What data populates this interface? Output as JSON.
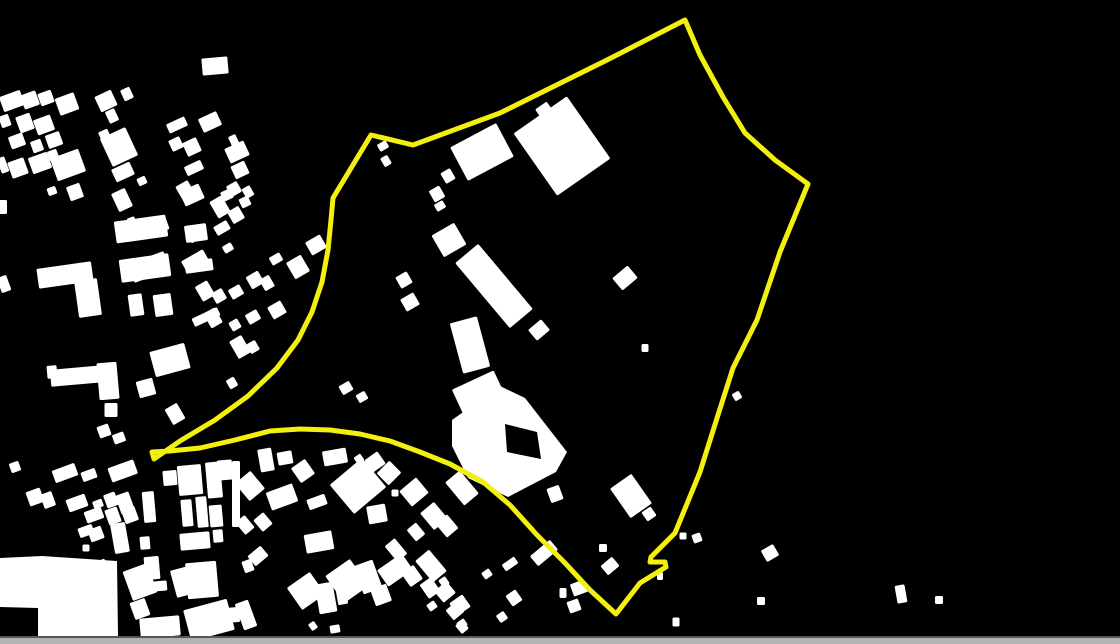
{
  "scene": {
    "width": 1120,
    "height": 644,
    "background_color": "#000000"
  },
  "map": {
    "building_color": "#ffffff",
    "buildings": [
      [
        12,
        101,
        22,
        16,
        -20
      ],
      [
        30,
        100,
        16,
        15,
        -20
      ],
      [
        46,
        98,
        14,
        13,
        -20
      ],
      [
        67,
        104,
        20,
        18,
        -20
      ],
      [
        106,
        101,
        18,
        17,
        -25
      ],
      [
        112,
        116,
        10,
        13,
        -25
      ],
      [
        127,
        94,
        10,
        12,
        -25
      ],
      [
        5,
        121,
        10,
        12,
        -20
      ],
      [
        25,
        123,
        15,
        17,
        -20
      ],
      [
        44,
        125,
        18,
        16,
        -20
      ],
      [
        54,
        140,
        15,
        14,
        -20
      ],
      [
        17,
        141,
        15,
        13,
        -20
      ],
      [
        37,
        146,
        11,
        12,
        -20
      ],
      [
        53,
        155,
        10,
        10,
        -20
      ],
      [
        3,
        165,
        8,
        16,
        -20
      ],
      [
        18,
        168,
        17,
        17,
        -20
      ],
      [
        40,
        163,
        20,
        17,
        -20
      ],
      [
        68,
        165,
        30,
        24,
        -20
      ],
      [
        75,
        192,
        14,
        15,
        -20
      ],
      [
        52,
        191,
        9,
        8,
        -20
      ],
      [
        105,
        136,
        10,
        12,
        -25
      ],
      [
        119,
        147,
        28,
        31,
        -25
      ],
      [
        123,
        172,
        20,
        14,
        -25
      ],
      [
        142,
        181,
        9,
        8,
        -25
      ],
      [
        122,
        200,
        15,
        20,
        -25
      ],
      [
        177,
        125,
        20,
        10,
        -25
      ],
      [
        176,
        144,
        12,
        12,
        -25
      ],
      [
        192,
        147,
        15,
        15,
        -25
      ],
      [
        194,
        168,
        18,
        10,
        -25
      ],
      [
        210,
        122,
        20,
        15,
        -25
      ],
      [
        215,
        66,
        26,
        17,
        -5
      ],
      [
        234,
        141,
        8,
        12,
        -25
      ],
      [
        237,
        152,
        21,
        16,
        -25
      ],
      [
        240,
        170,
        15,
        14,
        -25
      ],
      [
        227,
        195,
        11,
        10,
        -25
      ],
      [
        245,
        202,
        10,
        10,
        -25
      ],
      [
        192,
        195,
        21,
        16,
        -25
      ],
      [
        3,
        207,
        8,
        14,
        0
      ],
      [
        4,
        284,
        10,
        16,
        -20
      ],
      [
        65,
        275,
        55,
        20,
        -8
      ],
      [
        88,
        298,
        23,
        37,
        -8
      ],
      [
        141,
        229,
        52,
        22,
        -8
      ],
      [
        145,
        268,
        50,
        23,
        -8
      ],
      [
        136,
        305,
        14,
        22,
        -8
      ],
      [
        163,
        305,
        18,
        22,
        -8
      ],
      [
        196,
        233,
        22,
        17,
        -8
      ],
      [
        199,
        266,
        28,
        12,
        -8
      ],
      [
        206,
        317,
        28,
        9,
        -25
      ],
      [
        170,
        360,
        36,
        26,
        -15
      ],
      [
        77,
        376,
        53,
        17,
        -5
      ],
      [
        52,
        372,
        10,
        13,
        -5
      ],
      [
        108,
        381,
        20,
        37,
        -5
      ],
      [
        111,
        410,
        13,
        14,
        0
      ],
      [
        175,
        414,
        14,
        18,
        -30
      ],
      [
        104,
        431,
        12,
        12,
        -20
      ],
      [
        119,
        438,
        12,
        10,
        -20
      ],
      [
        146,
        388,
        17,
        17,
        -15
      ],
      [
        185,
        190,
        14,
        15,
        -30
      ],
      [
        220,
        207,
        14,
        19,
        -30
      ],
      [
        234,
        189,
        12,
        12,
        -30
      ],
      [
        248,
        192,
        9,
        11,
        -30
      ],
      [
        236,
        215,
        13,
        14,
        -30
      ],
      [
        222,
        228,
        15,
        10,
        -30
      ],
      [
        196,
        234,
        17,
        12,
        -30
      ],
      [
        133,
        225,
        8,
        16,
        -20
      ],
      [
        153,
        227,
        30,
        15,
        -20
      ],
      [
        149,
        267,
        38,
        20,
        -20
      ],
      [
        195,
        261,
        25,
        13,
        -30
      ],
      [
        228,
        248,
        10,
        8,
        -30
      ],
      [
        298,
        267,
        17,
        19,
        -30
      ],
      [
        316,
        245,
        17,
        15,
        -30
      ],
      [
        276,
        259,
        12,
        9,
        -30
      ],
      [
        205,
        291,
        14,
        17,
        -30
      ],
      [
        219,
        296,
        12,
        12,
        -30
      ],
      [
        236,
        292,
        13,
        11,
        -30
      ],
      [
        255,
        280,
        14,
        14,
        -30
      ],
      [
        267,
        283,
        11,
        13,
        -30
      ],
      [
        277,
        310,
        15,
        14,
        -30
      ],
      [
        253,
        317,
        13,
        11,
        -30
      ],
      [
        235,
        325,
        10,
        10,
        -30
      ],
      [
        213,
        318,
        13,
        17,
        -30
      ],
      [
        240,
        347,
        14,
        20,
        -30
      ],
      [
        253,
        347,
        10,
        11,
        -30
      ],
      [
        232,
        383,
        9,
        10,
        -30
      ],
      [
        346,
        388,
        12,
        10,
        -30
      ],
      [
        362,
        397,
        10,
        9,
        -30
      ],
      [
        383,
        146,
        10,
        8,
        -30
      ],
      [
        386,
        161,
        8,
        10,
        -30
      ],
      [
        562,
        146,
        65,
        76,
        -35
      ],
      [
        544,
        110,
        14,
        11,
        -35
      ],
      [
        482,
        152,
        52,
        38,
        -28
      ],
      [
        448,
        176,
        11,
        12,
        -30
      ],
      [
        437,
        194,
        12,
        13,
        -30
      ],
      [
        440,
        206,
        10,
        8,
        -30
      ],
      [
        449,
        240,
        26,
        25,
        -30
      ],
      [
        494,
        286,
        30,
        85,
        -40
      ],
      [
        539,
        330,
        17,
        14,
        -40
      ],
      [
        625,
        278,
        20,
        16,
        -40
      ],
      [
        645,
        348,
        7,
        8,
        0
      ],
      [
        737,
        396,
        8,
        8,
        -30
      ],
      [
        404,
        280,
        13,
        13,
        -30
      ],
      [
        410,
        302,
        15,
        14,
        -30
      ],
      [
        631,
        496,
        26,
        36,
        -35
      ],
      [
        649,
        514,
        11,
        11,
        -35
      ],
      [
        555,
        494,
        13,
        15,
        -20
      ],
      [
        603,
        548,
        8,
        8,
        0
      ],
      [
        683,
        536,
        7,
        7,
        0
      ],
      [
        697,
        538,
        9,
        9,
        -20
      ],
      [
        470,
        345,
        28,
        52,
        -15
      ],
      [
        482,
        400,
        46,
        44,
        -25
      ],
      [
        266,
        460,
        14,
        23,
        -10
      ],
      [
        285,
        458,
        15,
        13,
        -10
      ],
      [
        303,
        471,
        17,
        18,
        -35
      ],
      [
        335,
        457,
        24,
        15,
        -10
      ],
      [
        359,
        459,
        8,
        8,
        -35
      ],
      [
        375,
        462,
        16,
        15,
        -35
      ],
      [
        389,
        473,
        18,
        17,
        -45
      ],
      [
        358,
        486,
        42,
        38,
        -40
      ],
      [
        395,
        493,
        7,
        7,
        0
      ],
      [
        414,
        492,
        22,
        20,
        -40
      ],
      [
        462,
        488,
        19,
        30,
        -40
      ],
      [
        250,
        486,
        20,
        23,
        -40
      ],
      [
        282,
        497,
        28,
        19,
        -20
      ],
      [
        317,
        502,
        19,
        11,
        -20
      ],
      [
        377,
        514,
        19,
        18,
        -10
      ],
      [
        434,
        516,
        18,
        22,
        -40
      ],
      [
        263,
        522,
        13,
        15,
        -40
      ],
      [
        447,
        526,
        15,
        18,
        -40
      ],
      [
        416,
        532,
        12,
        15,
        -40
      ],
      [
        319,
        542,
        28,
        19,
        -10
      ],
      [
        258,
        556,
        17,
        13,
        -40
      ],
      [
        396,
        550,
        13,
        20,
        -40
      ],
      [
        431,
        566,
        18,
        28,
        -40
      ],
      [
        368,
        577,
        20,
        30,
        -20
      ],
      [
        381,
        595,
        17,
        18,
        -20
      ],
      [
        326,
        598,
        18,
        30,
        -10
      ],
      [
        342,
        597,
        10,
        15,
        -10
      ],
      [
        445,
        592,
        16,
        15,
        -40
      ],
      [
        455,
        611,
        14,
        13,
        -40
      ],
      [
        335,
        629,
        10,
        8,
        -10
      ],
      [
        462,
        627,
        9,
        11,
        -40
      ],
      [
        245,
        525,
        12,
        16,
        -40
      ],
      [
        246,
        615,
        14,
        28,
        -20
      ],
      [
        15,
        467,
        10,
        10,
        -20
      ],
      [
        65,
        473,
        24,
        13,
        -20
      ],
      [
        89,
        475,
        15,
        10,
        -20
      ],
      [
        117,
        473,
        15,
        15,
        -20
      ],
      [
        128,
        469,
        16,
        15,
        -20
      ],
      [
        35,
        497,
        15,
        15,
        -20
      ],
      [
        48,
        500,
        12,
        15,
        -20
      ],
      [
        77,
        503,
        20,
        13,
        -20
      ],
      [
        98,
        504,
        10,
        8,
        -20
      ],
      [
        111,
        500,
        12,
        14,
        -20
      ],
      [
        125,
        503,
        14,
        20,
        -20
      ],
      [
        94,
        515,
        18,
        12,
        -20
      ],
      [
        113,
        516,
        13,
        16,
        -20
      ],
      [
        130,
        515,
        14,
        15,
        -20
      ],
      [
        86,
        531,
        15,
        10,
        -20
      ],
      [
        96,
        534,
        14,
        13,
        -20
      ],
      [
        120,
        538,
        15,
        30,
        -10
      ],
      [
        149,
        507,
        12,
        31,
        -5
      ],
      [
        145,
        543,
        10,
        13,
        -5
      ],
      [
        86,
        548,
        7,
        7,
        0
      ],
      [
        152,
        568,
        15,
        23,
        -5
      ],
      [
        160,
        586,
        14,
        10,
        -5
      ],
      [
        170,
        478,
        14,
        15,
        -5
      ],
      [
        190,
        480,
        24,
        30,
        -5
      ],
      [
        214,
        480,
        15,
        36,
        -5
      ],
      [
        225,
        470,
        15,
        20,
        -5
      ],
      [
        236,
        494,
        8,
        66,
        0
      ],
      [
        187,
        513,
        11,
        27,
        -5
      ],
      [
        202,
        512,
        11,
        31,
        -5
      ],
      [
        216,
        516,
        13,
        22,
        -5
      ],
      [
        195,
        541,
        30,
        17,
        -5
      ],
      [
        218,
        536,
        10,
        13,
        -5
      ],
      [
        202,
        580,
        31,
        36,
        -5
      ],
      [
        205,
        615,
        15,
        14,
        -5
      ],
      [
        232,
        615,
        15,
        15,
        -5
      ],
      [
        160,
        627,
        40,
        20,
        -5
      ],
      [
        103,
        570,
        12,
        20,
        -25
      ],
      [
        140,
        582,
        26,
        31,
        -20
      ],
      [
        140,
        609,
        16,
        18,
        -20
      ],
      [
        190,
        580,
        34,
        28,
        -15
      ],
      [
        209,
        620,
        45,
        32,
        -15
      ],
      [
        248,
        566,
        10,
        12,
        -20
      ],
      [
        306,
        591,
        28,
        27,
        -35
      ],
      [
        347,
        581,
        30,
        33,
        -35
      ],
      [
        313,
        626,
        7,
        8,
        -35
      ],
      [
        395,
        570,
        30,
        20,
        -35
      ],
      [
        412,
        576,
        15,
        17,
        -35
      ],
      [
        430,
        588,
        14,
        17,
        -35
      ],
      [
        444,
        582,
        8,
        9,
        -35
      ],
      [
        432,
        606,
        9,
        8,
        -35
      ],
      [
        460,
        605,
        16,
        15,
        -35
      ],
      [
        462,
        624,
        9,
        8,
        -35
      ],
      [
        487,
        574,
        9,
        8,
        -35
      ],
      [
        510,
        564,
        15,
        8,
        -35
      ],
      [
        514,
        598,
        12,
        13,
        -35
      ],
      [
        502,
        617,
        9,
        9,
        -35
      ],
      [
        544,
        553,
        26,
        13,
        -40
      ],
      [
        610,
        566,
        15,
        12,
        -40
      ],
      [
        660,
        576,
        6,
        8,
        0
      ],
      [
        563,
        593,
        7,
        10,
        0
      ],
      [
        579,
        588,
        15,
        13,
        -20
      ],
      [
        574,
        606,
        12,
        12,
        -20
      ],
      [
        676,
        622,
        7,
        9,
        0
      ],
      [
        761,
        601,
        8,
        8,
        0
      ],
      [
        770,
        553,
        14,
        13,
        -30
      ],
      [
        901,
        594,
        10,
        18,
        -10
      ],
      [
        939,
        600,
        8,
        8,
        0
      ],
      [
        1037,
        639,
        8,
        5,
        0
      ]
    ],
    "special_shapes": [
      {
        "name": "courtyard-building",
        "path": "M452,420 L500,386 L525,398 L567,452 L556,472 L508,497 L468,478 L452,446 Z M505,424 L537,432 L541,459 L507,452 Z"
      },
      {
        "name": "plateau-building",
        "path": "M0,558 L42,556 L117,561 L118,636 L38,636 L38,608 L0,607 Z"
      }
    ],
    "boundary": {
      "color": "#f3ef0e",
      "stroke_width": 5,
      "points": "685,20 700,55 723,97 745,133 775,160 808,184 780,252 757,320 733,368 718,415 700,472 675,533 651,557 650,562 665,562 666,567 640,583 616,614 590,590 565,563 537,535 510,505 483,482 450,464 420,452 390,441 360,434 330,430 300,429 270,431 235,440 200,448 170,451 152,452 154,459 180,441 215,420 248,396 277,368 298,340 312,312 322,282 328,250 331,220 333,198 371,135 413,145 500,113 607,60"
    }
  },
  "scrollbar": {
    "track_color": "#b3b3b3",
    "border_color": "#565656",
    "height": 8
  }
}
